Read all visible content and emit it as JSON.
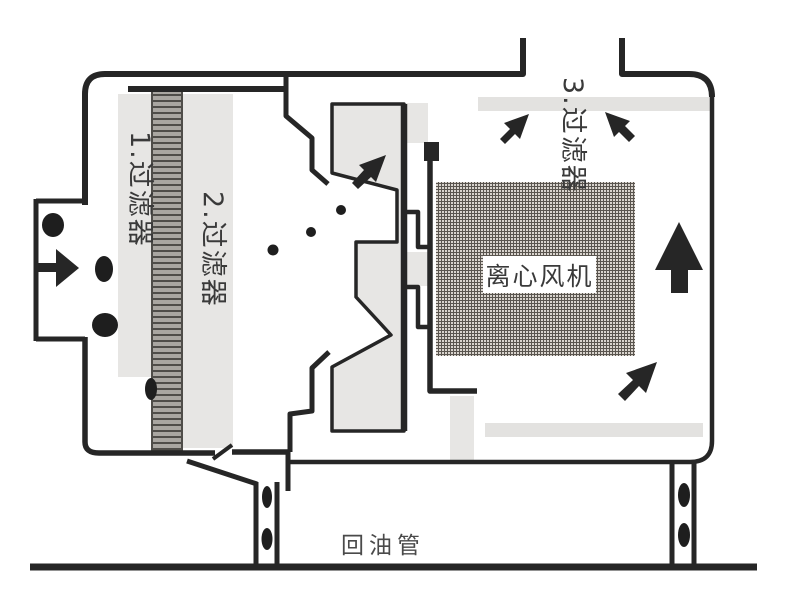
{
  "diagram": {
    "type": "oil-mist-collector-cross-section",
    "labels": {
      "filter1": "1.过滤器",
      "filter2": "2.过滤器",
      "filter3": "3.过滤器",
      "fan": "离心风机",
      "oil_return": "回油管"
    },
    "icons": [
      "inlet-right-arrow",
      "baffle-up-right-arrow",
      "exhaust-up-right-arrow",
      "exhaust-up-left-arrow",
      "riser-up-arrow",
      "duct-up-right-arrow",
      "oil-droplets"
    ],
    "colors": {
      "line": "#262626",
      "panel_gray": "#e7e6e4",
      "filter_bar_gray": "#e3e2e0",
      "hatch_bg": "#a9a6a1",
      "hatch_dark": "#4f4d49",
      "grid_bg": "#d9d4ce",
      "grid_line": "#5a554f",
      "text": "#3a3a3a",
      "droplet": "#1e1e1e"
    }
  }
}
